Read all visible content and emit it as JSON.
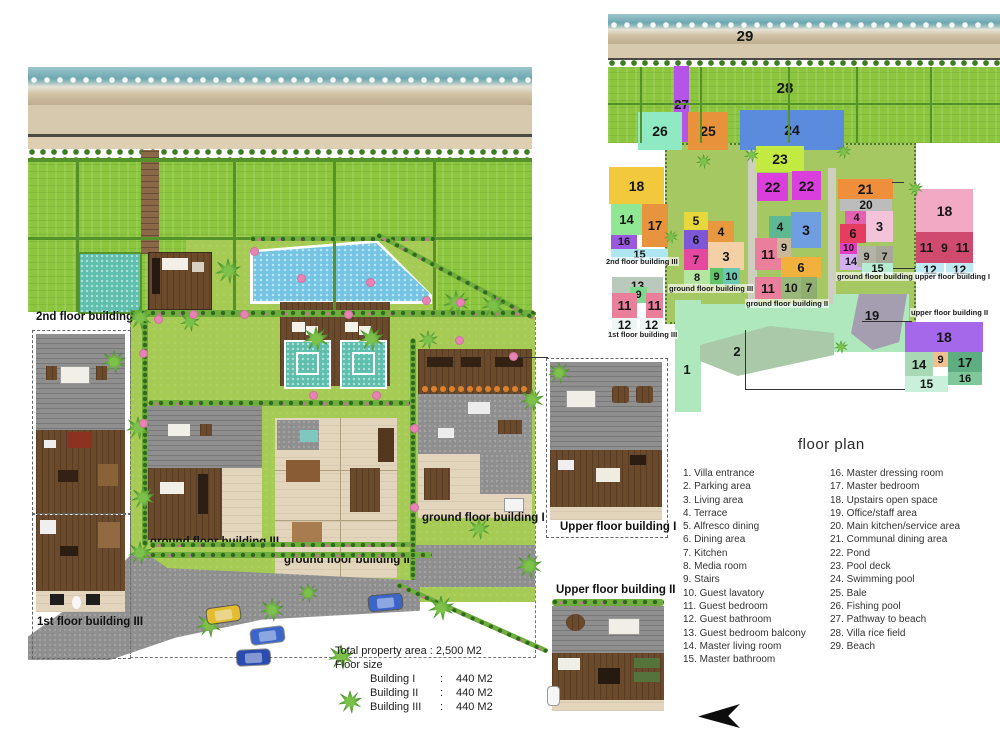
{
  "site_plan": {
    "building_labels": [
      {
        "text": "2nd floor building III",
        "x": 36,
        "y": 311
      },
      {
        "text": "1st floor building III",
        "x": 37,
        "y": 616
      },
      {
        "text": "ground floor building III",
        "x": 150,
        "y": 536
      },
      {
        "text": "ground floor building II",
        "x": 284,
        "y": 554
      },
      {
        "text": "ground floor building I",
        "x": 422,
        "y": 512
      },
      {
        "text": "Upper floor building I",
        "x": 560,
        "y": 521
      },
      {
        "text": "Upper floor building II",
        "x": 556,
        "y": 584
      }
    ],
    "property_info": {
      "total": "Total property area : 2,500 M2",
      "floor_size_heading": "Floor size",
      "buildings": [
        {
          "name": "Building I",
          "colon": ":",
          "value": "440 M2"
        },
        {
          "name": "Building II",
          "colon": ":",
          "value": "440 M2"
        },
        {
          "name": "Building III",
          "colon": ":",
          "value": "440 M2"
        }
      ]
    }
  },
  "schematic": {
    "floor_labels": [
      {
        "text": "2nd floor building III",
        "x": 605,
        "y": 257
      },
      {
        "text": "1st floor building III",
        "x": 607,
        "y": 330
      },
      {
        "text": "ground floor building III",
        "x": 668,
        "y": 284
      },
      {
        "text": "ground floor building II",
        "x": 745,
        "y": 299
      },
      {
        "text": "ground floor building I",
        "x": 836,
        "y": 272
      },
      {
        "text": "upper floor building I",
        "x": 914,
        "y": 272
      },
      {
        "text": "upper floor building II",
        "x": 910,
        "y": 308
      }
    ],
    "regions": [
      {
        "n": "29",
        "x": 728,
        "y": 26,
        "w": 34,
        "h": 20,
        "c": "transparent",
        "fs": 15
      },
      {
        "n": "28",
        "x": 768,
        "y": 78,
        "w": 34,
        "h": 20,
        "c": "transparent",
        "fs": 15
      },
      {
        "n": "27",
        "x": 674,
        "y": 66,
        "w": 15,
        "h": 76,
        "c": "#b455e8",
        "fs": 13
      },
      {
        "n": "26",
        "x": 638,
        "y": 112,
        "w": 44,
        "h": 38,
        "c": "#8fe9c2",
        "fs": 14
      },
      {
        "n": "25",
        "x": 688,
        "y": 112,
        "w": 40,
        "h": 38,
        "c": "#e8923c",
        "fs": 14
      },
      {
        "n": "24",
        "x": 740,
        "y": 110,
        "w": 104,
        "h": 40,
        "c": "#5b8bdc",
        "fs": 14
      },
      {
        "n": "23",
        "x": 756,
        "y": 146,
        "w": 48,
        "h": 26,
        "c": "#c2ea41",
        "fs": 14
      },
      {
        "n": "22",
        "x": 757,
        "y": 173,
        "w": 31,
        "h": 28,
        "c": "#da3edd",
        "fs": 14
      },
      {
        "n": "22",
        "x": 792,
        "y": 171,
        "w": 29,
        "h": 29,
        "c": "#da3edd",
        "fs": 14
      },
      {
        "n": "18",
        "x": 609,
        "y": 167,
        "w": 55,
        "h": 37,
        "c": "#f2c93c",
        "fs": 14
      },
      {
        "n": "14",
        "x": 611,
        "y": 204,
        "w": 31,
        "h": 31,
        "c": "#90e894",
        "fs": 13
      },
      {
        "n": "17",
        "x": 642,
        "y": 204,
        "w": 26,
        "h": 43,
        "c": "#e8943e",
        "fs": 13
      },
      {
        "n": "16",
        "x": 611,
        "y": 235,
        "w": 26,
        "h": 14,
        "c": "#9b59e0",
        "fs": 11
      },
      {
        "n": "15",
        "x": 611,
        "y": 249,
        "w": 57,
        "h": 12,
        "c": "#ade7f2",
        "fs": 11
      },
      {
        "n": "13",
        "x": 612,
        "y": 277,
        "w": 51,
        "h": 17,
        "c": "#b9c9bc",
        "fs": 12
      },
      {
        "n": "9",
        "x": 630,
        "y": 287,
        "w": 17,
        "h": 16,
        "c": "#7fd98f",
        "fs": 11
      },
      {
        "n": "11",
        "x": 612,
        "y": 293,
        "w": 25,
        "h": 25,
        "c": "#e97f9b",
        "fs": 13
      },
      {
        "n": "11",
        "x": 646,
        "y": 293,
        "w": 17,
        "h": 25,
        "c": "#e97f9b",
        "fs": 13
      },
      {
        "n": "12",
        "x": 612,
        "y": 318,
        "w": 25,
        "h": 14,
        "c": "#edf6f4",
        "fs": 12
      },
      {
        "n": "12",
        "x": 640,
        "y": 318,
        "w": 23,
        "h": 14,
        "c": "#edf6f4",
        "fs": 12
      },
      {
        "n": "5",
        "x": 684,
        "y": 212,
        "w": 24,
        "h": 18,
        "c": "#e6d83a",
        "fs": 12
      },
      {
        "n": "6",
        "x": 684,
        "y": 230,
        "w": 24,
        "h": 19,
        "c": "#7e57d8",
        "fs": 12
      },
      {
        "n": "4",
        "x": 708,
        "y": 221,
        "w": 26,
        "h": 21,
        "c": "#e8993f",
        "fs": 12
      },
      {
        "n": "7",
        "x": 684,
        "y": 249,
        "w": 24,
        "h": 21,
        "c": "#e4489f",
        "fs": 12
      },
      {
        "n": "3",
        "x": 708,
        "y": 242,
        "w": 36,
        "h": 28,
        "c": "#f5cfa5",
        "fs": 13
      },
      {
        "n": "8",
        "x": 684,
        "y": 270,
        "w": 26,
        "h": 15,
        "c": "#b5e6a0",
        "fs": 11
      },
      {
        "n": "9",
        "x": 710,
        "y": 268,
        "w": 13,
        "h": 17,
        "c": "#62c46a",
        "fs": 11
      },
      {
        "n": "10",
        "x": 723,
        "y": 268,
        "w": 17,
        "h": 17,
        "c": "#6cc8b0",
        "fs": 11
      },
      {
        "n": "4",
        "x": 769,
        "y": 216,
        "w": 22,
        "h": 22,
        "c": "#5fb894",
        "fs": 12
      },
      {
        "n": "3",
        "x": 791,
        "y": 212,
        "w": 30,
        "h": 36,
        "c": "#6f9fe0",
        "fs": 14
      },
      {
        "n": "11",
        "x": 755,
        "y": 238,
        "w": 26,
        "h": 32,
        "c": "#e97f9b",
        "fs": 13
      },
      {
        "n": "9",
        "x": 777,
        "y": 238,
        "w": 14,
        "h": 20,
        "c": "#c9b99a",
        "fs": 11
      },
      {
        "n": "6",
        "x": 781,
        "y": 257,
        "w": 40,
        "h": 21,
        "c": "#f2b13d",
        "fs": 13
      },
      {
        "n": "11",
        "x": 755,
        "y": 277,
        "w": 26,
        "h": 22,
        "c": "#e97f9b",
        "fs": 13
      },
      {
        "n": "10",
        "x": 781,
        "y": 277,
        "w": 20,
        "h": 22,
        "c": "#9ab87a",
        "fs": 12
      },
      {
        "n": "7",
        "x": 801,
        "y": 277,
        "w": 16,
        "h": 22,
        "c": "#8fae6f",
        "fs": 12
      },
      {
        "n": "21",
        "x": 838,
        "y": 179,
        "w": 55,
        "h": 20,
        "c": "#ef8f3c",
        "fs": 14
      },
      {
        "n": "20",
        "x": 840,
        "y": 199,
        "w": 52,
        "h": 12,
        "c": "#bcbcbc",
        "fs": 12
      },
      {
        "n": "4",
        "x": 845,
        "y": 211,
        "w": 23,
        "h": 13,
        "c": "#e460b0",
        "fs": 11
      },
      {
        "n": "3",
        "x": 866,
        "y": 211,
        "w": 27,
        "h": 31,
        "c": "#f2c3d9",
        "fs": 13
      },
      {
        "n": "6",
        "x": 840,
        "y": 224,
        "w": 26,
        "h": 19,
        "c": "#e63c5f",
        "fs": 13
      },
      {
        "n": "10",
        "x": 840,
        "y": 243,
        "w": 17,
        "h": 11,
        "c": "#e43cc3",
        "fs": 10
      },
      {
        "n": "14",
        "x": 840,
        "y": 254,
        "w": 22,
        "h": 16,
        "c": "#d4aff0",
        "fs": 11
      },
      {
        "n": "9",
        "x": 857,
        "y": 246,
        "w": 19,
        "h": 21,
        "c": "#b3b3a6",
        "fs": 11
      },
      {
        "n": "7",
        "x": 876,
        "y": 246,
        "w": 17,
        "h": 21,
        "c": "#a8a89a",
        "fs": 11
      },
      {
        "n": "15",
        "x": 862,
        "y": 263,
        "w": 31,
        "h": 12,
        "c": "#b5ecd2",
        "fs": 11
      },
      {
        "n": "18",
        "x": 916,
        "y": 189,
        "w": 57,
        "h": 43,
        "c": "#f2a9c3",
        "fs": 14
      },
      {
        "n": "11",
        "x": 916,
        "y": 232,
        "w": 21,
        "h": 31,
        "c": "#cf4a6e",
        "fs": 13
      },
      {
        "n": "9",
        "x": 937,
        "y": 232,
        "w": 15,
        "h": 31,
        "c": "#cf4a6e",
        "fs": 12
      },
      {
        "n": "11",
        "x": 952,
        "y": 232,
        "w": 21,
        "h": 31,
        "c": "#cf4a6e",
        "fs": 13
      },
      {
        "n": "12",
        "x": 916,
        "y": 263,
        "w": 28,
        "h": 13,
        "c": "#bfeaf4",
        "fs": 12
      },
      {
        "n": "12",
        "x": 946,
        "y": 263,
        "w": 27,
        "h": 13,
        "c": "#bfeaf4",
        "fs": 12
      },
      {
        "n": "19",
        "x": 856,
        "y": 306,
        "w": 32,
        "h": 18,
        "c": "transparent",
        "fs": 13
      },
      {
        "n": "1",
        "x": 676,
        "y": 360,
        "w": 22,
        "h": 18,
        "c": "transparent",
        "fs": 13
      },
      {
        "n": "2",
        "x": 726,
        "y": 342,
        "w": 22,
        "h": 18,
        "c": "transparent",
        "fs": 13
      },
      {
        "n": "18",
        "x": 905,
        "y": 322,
        "w": 78,
        "h": 30,
        "c": "#a568ea",
        "fs": 14
      },
      {
        "n": "14",
        "x": 905,
        "y": 352,
        "w": 28,
        "h": 24,
        "c": "#a9d8b4",
        "fs": 13
      },
      {
        "n": "9",
        "x": 933,
        "y": 352,
        "w": 15,
        "h": 15,
        "c": "#f0c090",
        "fs": 11
      },
      {
        "n": "17",
        "x": 948,
        "y": 352,
        "w": 34,
        "h": 20,
        "c": "#5fae82",
        "fs": 13
      },
      {
        "n": "16",
        "x": 948,
        "y": 372,
        "w": 34,
        "h": 13,
        "c": "#7fc89a",
        "fs": 11
      },
      {
        "n": "15",
        "x": 905,
        "y": 376,
        "w": 43,
        "h": 16,
        "c": "#c9f0da",
        "fs": 12
      }
    ]
  },
  "legend": {
    "title": "floor plan",
    "column1": [
      "1. Villa entrance",
      "2. Parking area",
      "3. Living area",
      "4. Terrace",
      "5. Alfresco dining",
      "6. Dining area",
      "7. Kitchen",
      "8. Media room",
      "9. Stairs",
      "10. Guest lavatory",
      "11. Guest bedroom",
      "12. Guest bathroom",
      "13. Guest bedroom balcony",
      "14. Master living room",
      "15. Master bathroom"
    ],
    "column2": [
      "16. Master dressing room",
      "17. Master bedroom",
      "18. Upstairs open space",
      "19. Office/staff area",
      "20. Main kitchen/service area",
      "21. Communal dining area",
      "22. Pond",
      "23. Pool deck",
      "24. Swimming pool",
      "25. Bale",
      "26. Fishing pool",
      "27. Pathway to beach",
      "28. Villa rice field",
      "29. Beach"
    ]
  }
}
